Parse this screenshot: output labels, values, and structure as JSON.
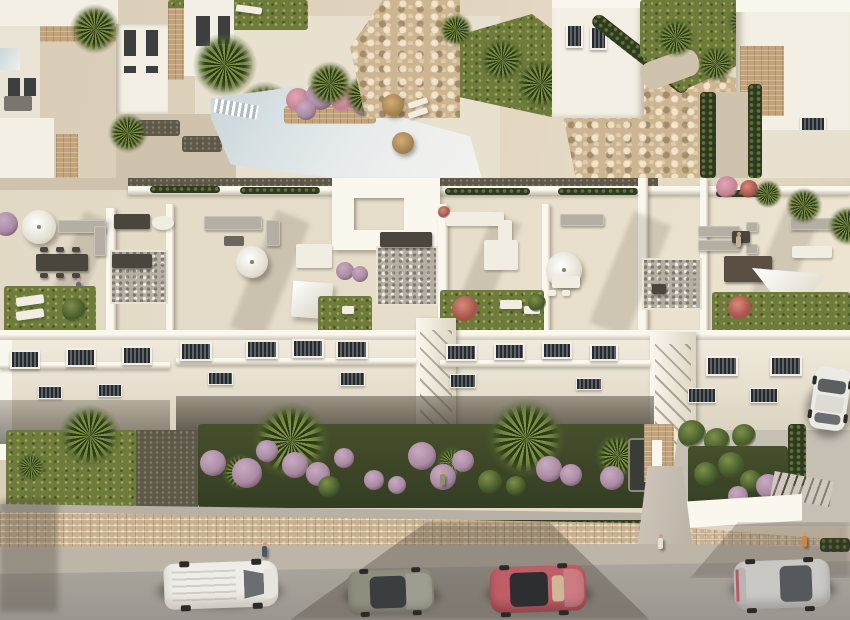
{
  "scene": {
    "type": "architectural-aerial-render",
    "description": "Aerial 3D render of a white Mediterranean-style apartment complex with rooftop terraces, a communal swimming pool, rocky landscaped slopes, gardens with palms and purple flowering shrubs, a tan stone perimeter wall, and a street with parked cars and pedestrians",
    "lighting": "warm late-afternoon sun from upper right with long soft shadows"
  },
  "palette": {
    "sand": "#d9cdb8",
    "sand_light": "#e9e1cf",
    "path": "#cfc3ae",
    "white_wall": "#f3efe4",
    "white_bright": "#faf7ef",
    "wall_shade": "#c7bfae",
    "roof_floor": "#e6decb",
    "stone": "#c2a379",
    "rock": "#ccb590",
    "gravel": "#5e5849",
    "hedge": "#2f3b21",
    "lawn": "#6d7b3d",
    "palm_light": "#7b8c42",
    "purple": "#ab8aa4",
    "purple_light": "#c7abc1",
    "pink": "#c27f93",
    "red_bush": "#a5524c",
    "pool_edge": "#c9d5da",
    "pool_center": "#eff1ee",
    "road": "#a5a098",
    "sidewalk": "#beb5a9",
    "wall_brick": "#c9b190",
    "furn_gray": "#b5afa3",
    "furn_dark": "#4a453d",
    "furn_white": "#f1ede2",
    "glass": "#3c4043",
    "van": "#efede8",
    "car_olive": "#8f8e7e",
    "car_red": "#c05e66",
    "car_silver": "#c9c8c5",
    "car_white": "#eceae4"
  },
  "objects": {
    "main_building": {
      "style": "white modern apartments",
      "floors_visible": 3,
      "rooftop_terraces": 5,
      "terrace_features": [
        "parasols",
        "shade sails",
        "outdoor sofas",
        "dining tables",
        "sun loungers",
        "lawn patches",
        "pebble decks"
      ]
    },
    "amenities": [
      "swimming pool",
      "pool deck",
      "planter island with palms",
      "rock garden slope",
      "thatch parasols"
    ],
    "vegetation": [
      "palm trees",
      "purple flowering shrubs",
      "cypress hedges",
      "lawns",
      "banana plants"
    ],
    "vehicles": [
      {
        "kind": "van",
        "color": "white",
        "location": "street left"
      },
      {
        "kind": "hatchback",
        "color": "olive gray",
        "location": "street center-left, in building shadow"
      },
      {
        "kind": "coupe",
        "color": "red",
        "location": "street center-right"
      },
      {
        "kind": "hatchback",
        "color": "silver",
        "location": "street right"
      },
      {
        "kind": "car",
        "color": "white",
        "location": "driveway upper right"
      }
    ],
    "people_visible": 6
  }
}
